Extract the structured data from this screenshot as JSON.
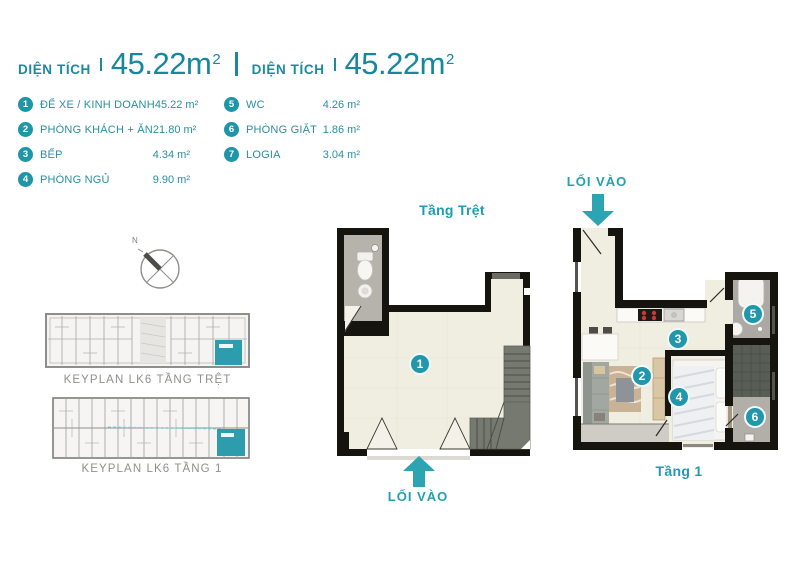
{
  "header": {
    "area_blocks": [
      {
        "label": "DIỆN TÍCH",
        "value": "45.22m",
        "unit_sup": "2"
      },
      {
        "label": "DIỆN TÍCH",
        "value": "45.22m",
        "unit_sup": "2"
      }
    ]
  },
  "legend": {
    "items": [
      {
        "num": "1",
        "label": "ĐỂ XE / KINH DOANH",
        "area": "45.22 m²"
      },
      {
        "num": "2",
        "label": "PHÒNG KHÁCH + ĂN",
        "area": "21.80 m²"
      },
      {
        "num": "3",
        "label": "BẾP",
        "area": "4.34 m²"
      },
      {
        "num": "4",
        "label": "PHÒNG NGỦ",
        "area": "9.90 m²"
      },
      {
        "num": "5",
        "label": "WC",
        "area": "4.26 m²"
      },
      {
        "num": "6",
        "label": "PHÒNG GIẶT",
        "area": "1.86 m²"
      },
      {
        "num": "7",
        "label": "LOGIA",
        "area": "3.04 m²"
      }
    ]
  },
  "compass": {
    "north_label": "N"
  },
  "keyplans": [
    {
      "caption": "KEYPLAN LK6 TẦNG TRỆT"
    },
    {
      "caption": "KEYPLAN LK6 TẦNG 1"
    }
  ],
  "plans": {
    "ground": {
      "title": "Tầng Trệt",
      "entrance_label": "LỐI VÀO",
      "markers": [
        {
          "num": "1"
        }
      ]
    },
    "first": {
      "title": "Tầng 1",
      "entrance_label": "LỐI VÀO",
      "markers": [
        {
          "num": "2"
        },
        {
          "num": "3"
        },
        {
          "num": "4"
        },
        {
          "num": "5"
        },
        {
          "num": "6"
        }
      ]
    }
  },
  "colors": {
    "teal_text": "#1b8a9e",
    "teal_accent": "#2097ab",
    "arrow_teal": "#2da4b2",
    "caption_gray": "#8f8f8c",
    "wall_black": "#16140f",
    "floor_cream": "#f0ede1",
    "keyplan_highlight": "#2d9dae"
  }
}
